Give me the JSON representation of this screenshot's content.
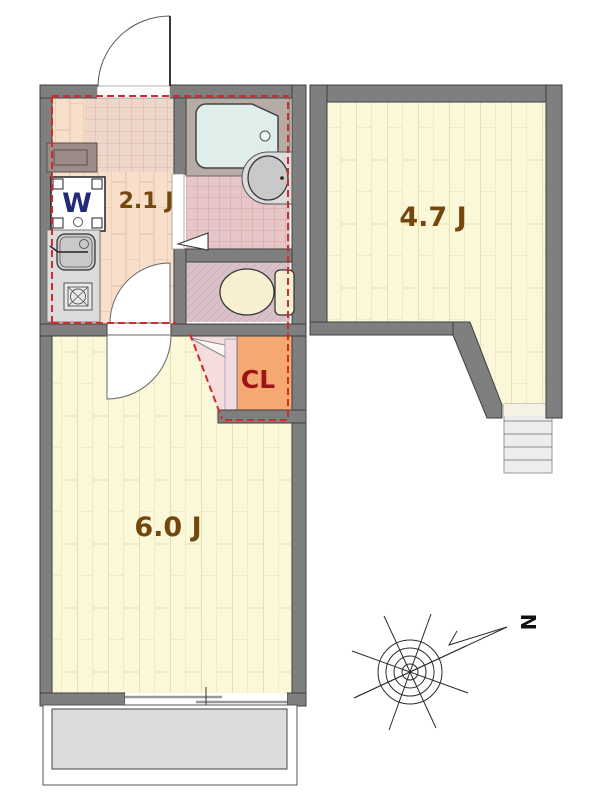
{
  "plan": {
    "type": "apartment-floor-plan",
    "rooms": {
      "kitchen": {
        "label": "2.1 J"
      },
      "main_room": {
        "label": "6.0 J"
      },
      "second_room": {
        "label": "4.7 J"
      },
      "closet": {
        "label": "CL"
      }
    },
    "fixtures": {
      "washing_machine_label": "W"
    },
    "compass": {
      "north_label": "N"
    }
  },
  "colors": {
    "wall": "#7f7f7f",
    "wall-outline": "#3f3f3f",
    "floor-cream": "#fbf8da",
    "floor-cream-line": "#e7dfae",
    "floor-peach": "#f7dfc9",
    "floor-peach-line": "#e5c2a6",
    "tile-genkan": "#eed7ca",
    "tile-genkan-line": "#dcb4a7",
    "tile-pink": "#e6c6c6",
    "tile-pink-line": "#d2a7a7",
    "toilet-floor": "#dac0c8",
    "toilet-floor-line": "#cdb0ba",
    "bath-platform": "#b7aba6",
    "tub": "#dfeeea",
    "fixture-light": "#dcdcdc",
    "fixture-mid": "#c9c9c9",
    "cream-fixture": "#f6f0d0",
    "closet": "#f5a971",
    "closet-door": "#f2dbe1",
    "swing": "#f3d8de",
    "shoe-cab": "#9b8b89",
    "label-brown": "#74470e",
    "label-red": "#9c1418",
    "washer-blue": "#222a78",
    "red-dash": "#d02c2c",
    "stairs": "#ededed",
    "balcony": "#dcdcdc"
  }
}
